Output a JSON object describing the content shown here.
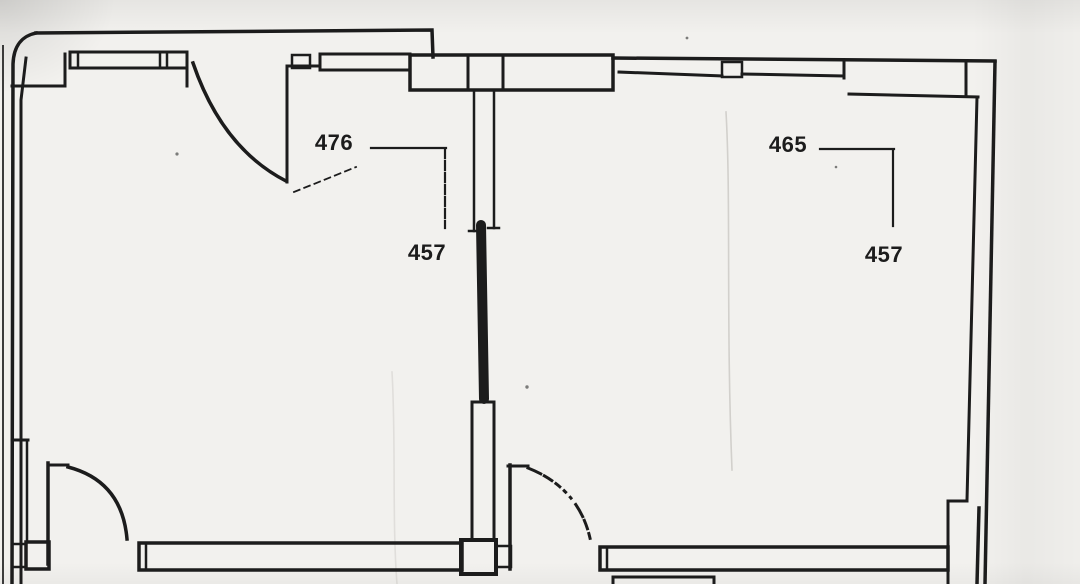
{
  "plan": {
    "type": "floor-plan-scan",
    "rooms": [
      {
        "id": "left",
        "width_label": "476",
        "depth_label": "457"
      },
      {
        "id": "right",
        "width_label": "465",
        "depth_label": "457"
      }
    ]
  },
  "colors": {
    "ink": "#1c1c1c",
    "paper": "#f2f1ee"
  }
}
